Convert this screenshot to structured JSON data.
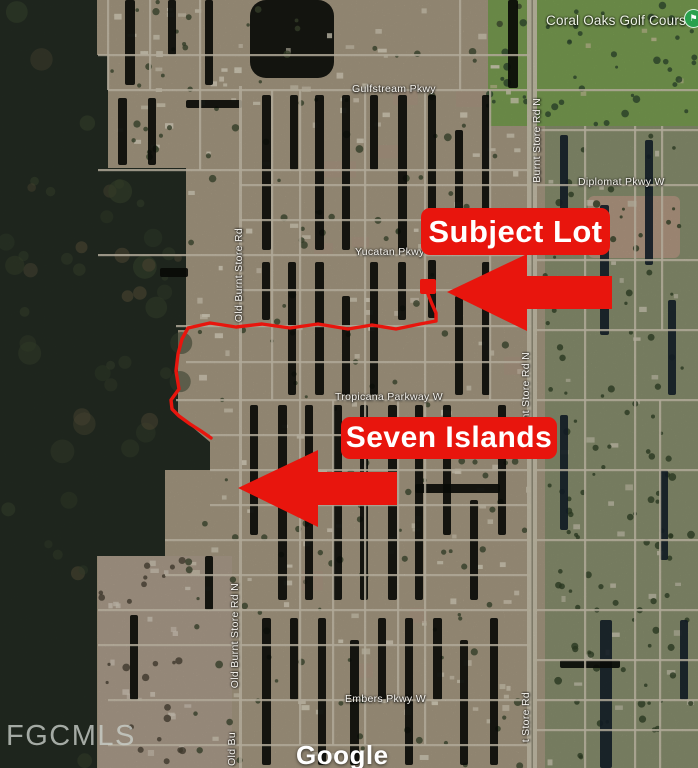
{
  "map": {
    "attribution_label": "Google",
    "mls_watermark": "FGCMLS",
    "poi": {
      "golf_course": {
        "label": "Coral Oaks Golf Course",
        "icon": "golf-flag-icon",
        "color": "#2aa14e"
      }
    },
    "roads": {
      "gulfstream": "Gulfstream Pkwy",
      "diplomat": "Diplomat Pkwy W",
      "yucatan": "Yucatan Pkwy",
      "tropicana": "Tropicana Parkway W",
      "embers": "Embers Pkwy W",
      "burnt_store_upper": "Burnt Store Rd N",
      "burnt_store_mid": "nt Store Rd N",
      "burnt_store_lower": "t Store Rd",
      "old_burnt_store_upper": "Old Burnt Store Rd",
      "old_burnt_store_lower": "Old Burnt Store Rd N",
      "old_burnt_store_bottom": "Old Bu"
    },
    "annotations": {
      "accent_color": "#e8150d",
      "subject_lot_label": "Subject Lot",
      "seven_islands_label": "Seven Islands"
    }
  }
}
